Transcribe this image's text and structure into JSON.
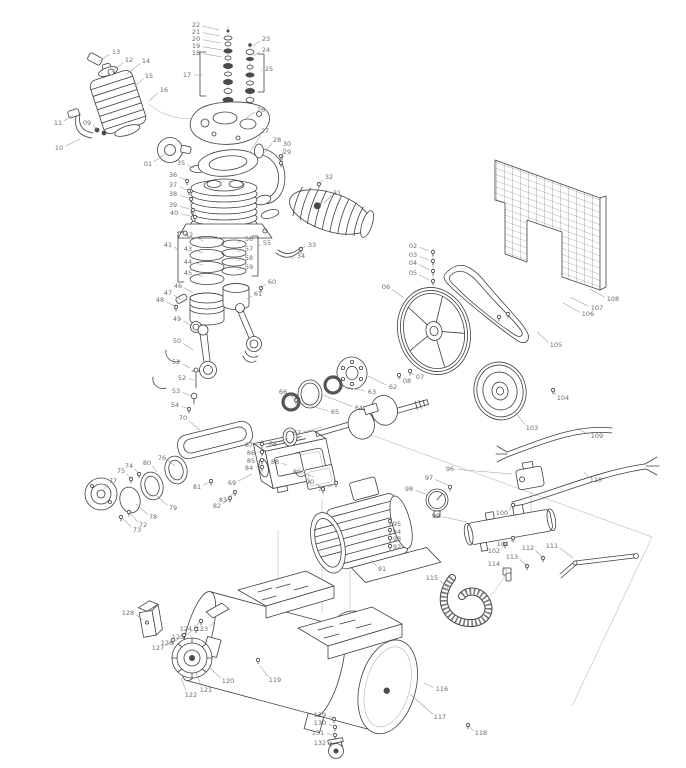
{
  "page": {
    "background": "#ffffff",
    "line_ink": "#3f3f3f",
    "label_color": "#6b6b6b",
    "leader_color": "#999999"
  },
  "diagram": {
    "type": "exploded-parts-diagram",
    "labels": [
      {
        "n": "01",
        "x": 148,
        "y": 164,
        "tx": 166,
        "ty": 153
      },
      {
        "n": "02",
        "x": 413,
        "y": 246,
        "tx": 429,
        "ty": 251
      },
      {
        "n": "03",
        "x": 413,
        "y": 255,
        "tx": 429,
        "ty": 260
      },
      {
        "n": "04",
        "x": 413,
        "y": 263,
        "tx": 429,
        "ty": 270
      },
      {
        "n": "05",
        "x": 413,
        "y": 273,
        "tx": 429,
        "ty": 280
      },
      {
        "n": "06",
        "x": 386,
        "y": 287,
        "tx": 404,
        "ty": 298
      },
      {
        "n": "07",
        "x": 420,
        "y": 377,
        "tx": 410,
        "ty": 372
      },
      {
        "n": "08",
        "x": 407,
        "y": 381,
        "tx": 399,
        "ty": 376
      },
      {
        "n": "09",
        "x": 87,
        "y": 123,
        "tx": 97,
        "ty": 129
      },
      {
        "n": "10",
        "x": 59,
        "y": 148,
        "tx": 80,
        "ty": 139
      },
      {
        "n": "11",
        "x": 58,
        "y": 123,
        "tx": 73,
        "ty": 115
      },
      {
        "n": "12",
        "x": 129,
        "y": 60,
        "tx": 112,
        "ty": 72
      },
      {
        "n": "13",
        "x": 116,
        "y": 52,
        "tx": 99,
        "ty": 61
      },
      {
        "n": "14",
        "x": 146,
        "y": 61,
        "tx": 127,
        "ty": 74
      },
      {
        "n": "15",
        "x": 149,
        "y": 76,
        "tx": 134,
        "ty": 87
      },
      {
        "n": "16",
        "x": 164,
        "y": 90,
        "tx": 149,
        "ty": 101
      },
      {
        "n": "17",
        "x": 187,
        "y": 75,
        "tx": 203,
        "ty": 75
      },
      {
        "n": "18",
        "x": 196,
        "y": 53,
        "tx": 222,
        "ty": 57
      },
      {
        "n": "19",
        "x": 196,
        "y": 46,
        "tx": 222,
        "ty": 50
      },
      {
        "n": "20",
        "x": 196,
        "y": 39,
        "tx": 221,
        "ty": 43
      },
      {
        "n": "21",
        "x": 196,
        "y": 32,
        "tx": 220,
        "ty": 36
      },
      {
        "n": "22",
        "x": 196,
        "y": 25,
        "tx": 219,
        "ty": 30
      },
      {
        "n": "23",
        "x": 266,
        "y": 39,
        "tx": 253,
        "ty": 46
      },
      {
        "n": "24",
        "x": 266,
        "y": 50,
        "tx": 253,
        "ty": 56
      },
      {
        "n": "25",
        "x": 269,
        "y": 69,
        "tx": 261,
        "ty": 71
      },
      {
        "n": "26",
        "x": 261,
        "y": 110,
        "tx": 246,
        "ty": 118
      },
      {
        "n": "27",
        "x": 265,
        "y": 131,
        "tx": 250,
        "ty": 152
      },
      {
        "n": "28",
        "x": 277,
        "y": 140,
        "tx": 264,
        "ty": 153
      },
      {
        "n": "29",
        "x": 287,
        "y": 152,
        "tx": 281,
        "ty": 163
      },
      {
        "n": "30",
        "x": 287,
        "y": 144,
        "tx": 281,
        "ty": 157
      },
      {
        "n": "31",
        "x": 337,
        "y": 193,
        "tx": 324,
        "ty": 203
      },
      {
        "n": "32",
        "x": 329,
        "y": 177,
        "tx": 319,
        "ty": 184
      },
      {
        "n": "33",
        "x": 312,
        "y": 245,
        "tx": 301,
        "ty": 249
      },
      {
        "n": "34",
        "x": 301,
        "y": 256,
        "tx": 291,
        "ty": 259
      },
      {
        "n": "35",
        "x": 181,
        "y": 163,
        "tx": 194,
        "ty": 168
      },
      {
        "n": "36",
        "x": 173,
        "y": 175,
        "tx": 187,
        "ty": 181
      },
      {
        "n": "37",
        "x": 173,
        "y": 185,
        "tx": 189,
        "ty": 191
      },
      {
        "n": "38",
        "x": 173,
        "y": 194,
        "tx": 191,
        "ty": 199
      },
      {
        "n": "39",
        "x": 173,
        "y": 205,
        "tx": 193,
        "ty": 210
      },
      {
        "n": "40",
        "x": 174,
        "y": 213,
        "tx": 195,
        "ty": 217
      },
      {
        "n": "41",
        "x": 168,
        "y": 245,
        "tx": 178,
        "ty": 250
      },
      {
        "n": "42",
        "x": 189,
        "y": 235,
        "tx": 203,
        "ty": 241
      },
      {
        "n": "43",
        "x": 188,
        "y": 249,
        "tx": 203,
        "ty": 253
      },
      {
        "n": "44",
        "x": 188,
        "y": 262,
        "tx": 203,
        "ty": 265
      },
      {
        "n": "45",
        "x": 188,
        "y": 273,
        "tx": 203,
        "ty": 277
      },
      {
        "n": "46",
        "x": 178,
        "y": 286,
        "tx": 193,
        "ty": 293
      },
      {
        "n": "47",
        "x": 168,
        "y": 293,
        "tx": 181,
        "ty": 300
      },
      {
        "n": "48",
        "x": 160,
        "y": 300,
        "tx": 176,
        "ty": 307
      },
      {
        "n": "49",
        "x": 177,
        "y": 319,
        "tx": 192,
        "ty": 326
      },
      {
        "n": "50",
        "x": 177,
        "y": 341,
        "tx": 193,
        "ty": 350
      },
      {
        "n": "51",
        "x": 176,
        "y": 362,
        "tx": 190,
        "ty": 368
      },
      {
        "n": "52",
        "x": 182,
        "y": 378,
        "tx": 194,
        "ty": 380
      },
      {
        "n": "53",
        "x": 176,
        "y": 391,
        "tx": 191,
        "ty": 396
      },
      {
        "n": "54",
        "x": 175,
        "y": 405,
        "tx": 189,
        "ty": 409
      },
      {
        "n": "55",
        "x": 267,
        "y": 243,
        "tx": 257,
        "ty": 247
      },
      {
        "n": "56",
        "x": 249,
        "y": 239,
        "tx": 237,
        "ty": 243
      },
      {
        "n": "57",
        "x": 249,
        "y": 249,
        "tx": 237,
        "ty": 252
      },
      {
        "n": "58",
        "x": 249,
        "y": 258,
        "tx": 237,
        "ty": 261
      },
      {
        "n": "59",
        "x": 249,
        "y": 267,
        "tx": 237,
        "ty": 270
      },
      {
        "n": "60",
        "x": 272,
        "y": 282,
        "tx": 261,
        "ty": 288
      },
      {
        "n": "61",
        "x": 258,
        "y": 294,
        "tx": 247,
        "ty": 299
      },
      {
        "n": "62",
        "x": 393,
        "y": 387,
        "tx": 368,
        "ty": 376
      },
      {
        "n": "63",
        "x": 372,
        "y": 392,
        "tx": 341,
        "ty": 386
      },
      {
        "n": "64",
        "x": 359,
        "y": 408,
        "tx": 323,
        "ty": 395
      },
      {
        "n": "65",
        "x": 335,
        "y": 412,
        "tx": 300,
        "ty": 403
      },
      {
        "n": "66",
        "x": 283,
        "y": 392,
        "tx": 296,
        "ty": 400
      },
      {
        "n": "67",
        "x": 297,
        "y": 433,
        "tx": 322,
        "ty": 427
      },
      {
        "n": "68",
        "x": 273,
        "y": 444,
        "tx": 288,
        "ty": 438
      },
      {
        "n": "69",
        "x": 232,
        "y": 483,
        "tx": 252,
        "ty": 474
      },
      {
        "n": "70",
        "x": 183,
        "y": 418,
        "tx": 200,
        "ty": 430
      },
      {
        "n": "71",
        "x": 322,
        "y": 489,
        "tx": 336,
        "ty": 483
      },
      {
        "n": "72",
        "x": 143,
        "y": 525,
        "tx": 130,
        "ty": 513
      },
      {
        "n": "73",
        "x": 137,
        "y": 530,
        "tx": 122,
        "ty": 518
      },
      {
        "n": "74",
        "x": 129,
        "y": 466,
        "tx": 139,
        "ty": 474
      },
      {
        "n": "75",
        "x": 121,
        "y": 471,
        "tx": 131,
        "ty": 479
      },
      {
        "n": "76",
        "x": 162,
        "y": 458,
        "tx": 175,
        "ty": 466
      },
      {
        "n": "77",
        "x": 113,
        "y": 481,
        "tx": 103,
        "ty": 490
      },
      {
        "n": "78",
        "x": 153,
        "y": 517,
        "tx": 136,
        "ty": 504
      },
      {
        "n": "79",
        "x": 173,
        "y": 508,
        "tx": 157,
        "ty": 496
      },
      {
        "n": "80",
        "x": 147,
        "y": 463,
        "tx": 157,
        "ty": 472
      },
      {
        "n": "81",
        "x": 197,
        "y": 487,
        "tx": 211,
        "ty": 481
      },
      {
        "n": "82",
        "x": 217,
        "y": 506,
        "tx": 230,
        "ty": 498
      },
      {
        "n": "83",
        "x": 223,
        "y": 500,
        "tx": 235,
        "ty": 492
      },
      {
        "n": "84",
        "x": 249,
        "y": 468,
        "tx": 260,
        "ty": 467
      },
      {
        "n": "85",
        "x": 251,
        "y": 461,
        "tx": 260,
        "ty": 460
      },
      {
        "n": "86",
        "x": 251,
        "y": 453,
        "tx": 260,
        "ty": 452
      },
      {
        "n": "87",
        "x": 249,
        "y": 445,
        "tx": 260,
        "ty": 444
      },
      {
        "n": "88",
        "x": 275,
        "y": 462,
        "tx": 287,
        "ty": 465
      },
      {
        "n": "89",
        "x": 297,
        "y": 472,
        "tx": 314,
        "ty": 477
      },
      {
        "n": "90",
        "x": 310,
        "y": 482,
        "tx": 323,
        "ty": 488
      },
      {
        "n": "91",
        "x": 382,
        "y": 569,
        "tx": 371,
        "ty": 560
      },
      {
        "n": "92",
        "x": 397,
        "y": 547,
        "tx": 390,
        "ty": 546
      },
      {
        "n": "93",
        "x": 397,
        "y": 539,
        "tx": 390,
        "ty": 538
      },
      {
        "n": "94",
        "x": 397,
        "y": 532,
        "tx": 390,
        "ty": 530
      },
      {
        "n": "95",
        "x": 397,
        "y": 524,
        "tx": 390,
        "ty": 520
      },
      {
        "n": "96",
        "x": 450,
        "y": 469,
        "tx": 512,
        "ty": 474
      },
      {
        "n": "97",
        "x": 429,
        "y": 478,
        "tx": 450,
        "ty": 486
      },
      {
        "n": "98",
        "x": 409,
        "y": 489,
        "tx": 428,
        "ty": 495
      },
      {
        "n": "99",
        "x": 436,
        "y": 516,
        "tx": 467,
        "ty": 522
      },
      {
        "n": "100",
        "x": 502,
        "y": 513,
        "tx": 512,
        "ty": 505
      },
      {
        "n": "101",
        "x": 503,
        "y": 544,
        "tx": 513,
        "ty": 538
      },
      {
        "n": "102",
        "x": 494,
        "y": 551,
        "tx": 505,
        "ty": 544
      },
      {
        "n": "103",
        "x": 532,
        "y": 428,
        "tx": 514,
        "ty": 411
      },
      {
        "n": "104",
        "x": 563,
        "y": 398,
        "tx": 553,
        "ty": 390
      },
      {
        "n": "105",
        "x": 556,
        "y": 345,
        "tx": 537,
        "ty": 332
      },
      {
        "n": "106",
        "x": 588,
        "y": 314,
        "tx": 563,
        "ty": 303
      },
      {
        "n": "107",
        "x": 597,
        "y": 308,
        "tx": 570,
        "ty": 297
      },
      {
        "n": "108",
        "x": 613,
        "y": 299,
        "tx": 590,
        "ty": 289
      },
      {
        "n": "109",
        "x": 597,
        "y": 436,
        "tx": 577,
        "ty": 428
      },
      {
        "n": "110",
        "x": 596,
        "y": 480,
        "tx": 584,
        "ty": 472
      },
      {
        "n": "111",
        "x": 552,
        "y": 546,
        "tx": 573,
        "ty": 558
      },
      {
        "n": "112",
        "x": 528,
        "y": 548,
        "tx": 543,
        "ty": 558
      },
      {
        "n": "113",
        "x": 512,
        "y": 557,
        "tx": 527,
        "ty": 566
      },
      {
        "n": "114",
        "x": 494,
        "y": 564,
        "tx": 507,
        "ty": 571
      },
      {
        "n": "115",
        "x": 432,
        "y": 578,
        "tx": 448,
        "ty": 588
      },
      {
        "n": "116",
        "x": 442,
        "y": 689,
        "tx": 424,
        "ty": 683
      },
      {
        "n": "117",
        "x": 440,
        "y": 717,
        "tx": 410,
        "ty": 694
      },
      {
        "n": "118",
        "x": 481,
        "y": 733,
        "tx": 468,
        "ty": 725
      },
      {
        "n": "119",
        "x": 275,
        "y": 680,
        "tx": 260,
        "ty": 666
      },
      {
        "n": "120",
        "x": 228,
        "y": 681,
        "tx": 209,
        "ty": 667
      },
      {
        "n": "121",
        "x": 206,
        "y": 690,
        "tx": 196,
        "ty": 673
      },
      {
        "n": "122",
        "x": 191,
        "y": 695,
        "tx": 181,
        "ty": 678
      },
      {
        "n": "123",
        "x": 202,
        "y": 629,
        "tx": 215,
        "ty": 621
      },
      {
        "n": "124",
        "x": 186,
        "y": 629,
        "tx": 200,
        "ty": 622
      },
      {
        "n": "125",
        "x": 178,
        "y": 637,
        "tx": 193,
        "ty": 630
      },
      {
        "n": "126",
        "x": 167,
        "y": 643,
        "tx": 182,
        "ty": 636
      },
      {
        "n": "127",
        "x": 158,
        "y": 648,
        "tx": 172,
        "ty": 641
      },
      {
        "n": "128",
        "x": 128,
        "y": 613,
        "tx": 143,
        "ty": 620
      },
      {
        "n": "129",
        "x": 320,
        "y": 715,
        "tx": 334,
        "ty": 719
      },
      {
        "n": "130",
        "x": 320,
        "y": 723,
        "tx": 334,
        "ty": 727
      },
      {
        "n": "131",
        "x": 318,
        "y": 733,
        "tx": 334,
        "ty": 735
      },
      {
        "n": "132",
        "x": 320,
        "y": 743,
        "tx": 335,
        "ty": 745
      }
    ],
    "fasteners": [
      {
        "x": 433,
        "y": 252
      },
      {
        "x": 433,
        "y": 261
      },
      {
        "x": 433,
        "y": 271
      },
      {
        "x": 433,
        "y": 281
      },
      {
        "x": 410,
        "y": 371
      },
      {
        "x": 399,
        "y": 375
      },
      {
        "x": 281,
        "y": 163
      },
      {
        "x": 281,
        "y": 156
      },
      {
        "x": 319,
        "y": 184
      },
      {
        "x": 301,
        "y": 249
      },
      {
        "x": 187,
        "y": 181
      },
      {
        "x": 189,
        "y": 191
      },
      {
        "x": 191,
        "y": 199
      },
      {
        "x": 193,
        "y": 210
      },
      {
        "x": 195,
        "y": 217
      },
      {
        "x": 176,
        "y": 307
      },
      {
        "x": 189,
        "y": 409
      },
      {
        "x": 261,
        "y": 288
      },
      {
        "x": 336,
        "y": 483
      },
      {
        "x": 129,
        "y": 512
      },
      {
        "x": 121,
        "y": 517
      },
      {
        "x": 139,
        "y": 474
      },
      {
        "x": 131,
        "y": 479
      },
      {
        "x": 211,
        "y": 481
      },
      {
        "x": 230,
        "y": 498
      },
      {
        "x": 235,
        "y": 492
      },
      {
        "x": 262,
        "y": 467
      },
      {
        "x": 262,
        "y": 460
      },
      {
        "x": 262,
        "y": 452
      },
      {
        "x": 262,
        "y": 444
      },
      {
        "x": 323,
        "y": 489
      },
      {
        "x": 390,
        "y": 546
      },
      {
        "x": 390,
        "y": 538
      },
      {
        "x": 390,
        "y": 530
      },
      {
        "x": 390,
        "y": 521
      },
      {
        "x": 450,
        "y": 487
      },
      {
        "x": 513,
        "y": 505
      },
      {
        "x": 513,
        "y": 538
      },
      {
        "x": 505,
        "y": 544
      },
      {
        "x": 499,
        "y": 317
      },
      {
        "x": 508,
        "y": 314
      },
      {
        "x": 543,
        "y": 558
      },
      {
        "x": 527,
        "y": 566
      },
      {
        "x": 468,
        "y": 725
      },
      {
        "x": 258,
        "y": 660
      },
      {
        "x": 201,
        "y": 621
      },
      {
        "x": 196,
        "y": 629
      },
      {
        "x": 184,
        "y": 635
      },
      {
        "x": 173,
        "y": 640
      },
      {
        "x": 334,
        "y": 719
      },
      {
        "x": 335,
        "y": 727
      },
      {
        "x": 335,
        "y": 735
      },
      {
        "x": 553,
        "y": 390
      },
      {
        "x": 296,
        "y": 400
      }
    ]
  }
}
